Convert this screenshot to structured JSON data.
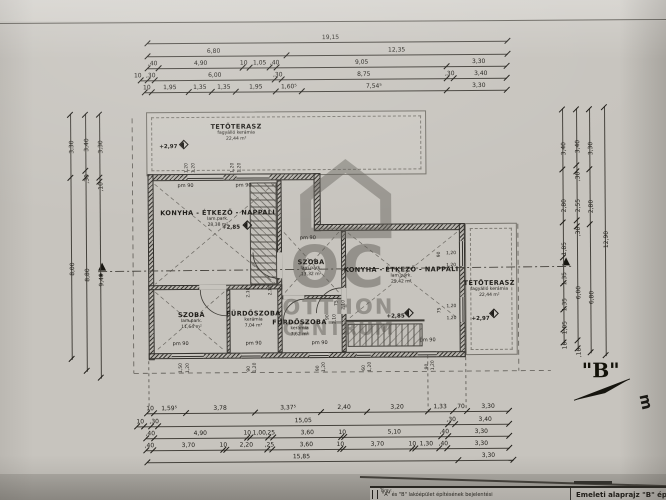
{
  "watermark": {
    "big": "OC",
    "line1": "OTTHON",
    "line2": "CENTRUM"
  },
  "markers": {
    "b": "\"B\"",
    "edge_letter": "m",
    "section_a": "A"
  },
  "pm_text": "pm 90",
  "title_block": {
    "left_label": "Tárgy:",
    "subject": "\"A\" és \"B\" lakóépület építésének bejelentési",
    "drawing": "Emeleti alaprajz \"B\" épü"
  },
  "rooms": [
    {
      "name": "TETŐTERASZ",
      "finish": "fagyálló kerámia",
      "area": "22,44 m²",
      "x": 237,
      "y": 122
    },
    {
      "name": "KONYHA - ÉTKEZŐ - NAPPALI",
      "finish": "lam.park.",
      "area": "28,38 m²",
      "x": 218,
      "y": 208
    },
    {
      "name": "SZOBA",
      "finish": "lam.park.",
      "area": "13,32 m²",
      "x": 311,
      "y": 258
    },
    {
      "name": "KONYHA - ÉTKEZŐ - NAPPALI",
      "finish": "lam.park.",
      "area": "25,42 m²",
      "x": 401,
      "y": 266
    },
    {
      "name": "SZOBA",
      "finish": "lam.park.",
      "area": "11,64 m²",
      "x": 191,
      "y": 310
    },
    {
      "name": "FÜRDŐSZOBA",
      "finish": "kerámia",
      "area": "7,04 m²",
      "x": 253,
      "y": 309
    },
    {
      "name": "FÜRDŐSZOBA",
      "finish": "kerámia",
      "area": "7,62 m²",
      "x": 299,
      "y": 318
    },
    {
      "name": "TETŐTERASZ",
      "finish": "fagyálló kerámia",
      "area": "22,44 m²",
      "x": 489,
      "y": 280
    }
  ],
  "levels": [
    {
      "t": "+2,97",
      "x": 160,
      "y": 143
    },
    {
      "t": "+2,85",
      "x": 222,
      "y": 224
    },
    {
      "t": "+2,85",
      "x": 386,
      "y": 314
    },
    {
      "t": "+2,97",
      "x": 471,
      "y": 317
    }
  ],
  "level_marks": [
    {
      "x": 181,
      "y": 140
    },
    {
      "x": 244,
      "y": 221
    },
    {
      "x": 405,
      "y": 310
    },
    {
      "x": 490,
      "y": 311
    }
  ],
  "pm_positions": [
    {
      "x": 178,
      "y": 182
    },
    {
      "x": 236,
      "y": 182
    },
    {
      "x": 300,
      "y": 235
    },
    {
      "x": 172,
      "y": 340
    },
    {
      "x": 245,
      "y": 340
    },
    {
      "x": 311,
      "y": 340
    },
    {
      "x": 419,
      "y": 338
    }
  ],
  "rot_labels": [
    {
      "t": "1,20",
      "x": 185,
      "y": 172
    },
    {
      "t": "1,20",
      "x": 192,
      "y": 172
    },
    {
      "t": "1,20",
      "x": 231,
      "y": 172
    },
    {
      "t": "1,20",
      "x": 238,
      "y": 172
    },
    {
      "t": "2,10",
      "x": 246,
      "y": 297
    },
    {
      "t": "2,10",
      "x": 268,
      "y": 295
    },
    {
      "t": "75",
      "x": 334,
      "y": 306
    },
    {
      "t": "2,10",
      "x": 341,
      "y": 310
    },
    {
      "t": "90",
      "x": 325,
      "y": 320
    },
    {
      "t": "2,10",
      "x": 332,
      "y": 324
    },
    {
      "t": "1,50",
      "x": 178,
      "y": 372
    },
    {
      "t": "1,20",
      "x": 185,
      "y": 372
    },
    {
      "t": "90",
      "x": 246,
      "y": 371
    },
    {
      "t": "1,20",
      "x": 252,
      "y": 372
    },
    {
      "t": "90",
      "x": 315,
      "y": 371
    },
    {
      "t": "1,20",
      "x": 321,
      "y": 372
    },
    {
      "t": "60",
      "x": 361,
      "y": 371
    },
    {
      "t": "1,20",
      "x": 367,
      "y": 372
    },
    {
      "t": "90",
      "x": 424,
      "y": 370
    },
    {
      "t": "1,20",
      "x": 430,
      "y": 371
    },
    {
      "t": "90",
      "x": 437,
      "y": 258
    },
    {
      "t": "75",
      "x": 437,
      "y": 314
    }
  ],
  "small_labels": [
    {
      "t": "1,20",
      "x": 446,
      "y": 252
    },
    {
      "t": "1,20",
      "x": 446,
      "y": 264
    },
    {
      "t": "1,20",
      "x": 446,
      "y": 305
    },
    {
      "t": "1,20",
      "x": 446,
      "y": 317
    }
  ],
  "dims": {
    "top": [
      {
        "y": 42,
        "x1": 149,
        "x2": 509,
        "ticks": [
          149,
          509
        ],
        "labels": [
          {
            "t": "19,15",
            "x": 332
          }
        ]
      },
      {
        "y": 55,
        "x1": 149,
        "x2": 509,
        "ticks": [
          149,
          288,
          509
        ],
        "labels": [
          {
            "t": "6,80",
            "x": 215
          },
          {
            "t": "12,35",
            "x": 398
          }
        ]
      },
      {
        "y": 67,
        "x1": 149,
        "x2": 508,
        "ticks": [
          149,
          160,
          244,
          251,
          271,
          278,
          448,
          508
        ],
        "labels": [
          {
            "t": ",40",
            "x": 154
          },
          {
            "t": "4,90",
            "x": 202
          },
          {
            "t": "10",
            "x": 245
          },
          {
            "t": "1,05",
            "x": 261
          },
          {
            "t": ",40",
            "x": 276
          },
          {
            "t": "9,05",
            "x": 363
          },
          {
            "t": "3,30",
            "x": 480
          }
        ]
      },
      {
        "y": 79,
        "x1": 142,
        "x2": 508,
        "ticks": [
          142,
          149,
          156,
          276,
          283,
          448,
          455,
          508
        ],
        "labels": [
          {
            "t": "10",
            "x": 139
          },
          {
            "t": ",30",
            "x": 152
          },
          {
            "t": "6,00",
            "x": 216
          },
          {
            "t": ",30",
            "x": 279
          },
          {
            "t": "8,75",
            "x": 365
          },
          {
            "t": ",30",
            "x": 451
          },
          {
            "t": "3,40",
            "x": 482
          }
        ]
      },
      {
        "y": 91,
        "x1": 146,
        "x2": 508,
        "ticks": [
          146,
          153,
          190,
          213,
          237,
          277,
          303,
          448,
          508
        ],
        "labels": [
          {
            "t": "10",
            "x": 148
          },
          {
            "t": "1,95",
            "x": 171
          },
          {
            "t": "1,35",
            "x": 201
          },
          {
            "t": "1,35",
            "x": 225
          },
          {
            "t": "1,95",
            "x": 257
          },
          {
            "t": "1,60⁵",
            "x": 290
          },
          {
            "t": "7,54⁵",
            "x": 375
          },
          {
            "t": "3,30",
            "x": 480
          }
        ]
      }
    ],
    "bottom": [
      {
        "y": 412,
        "x1": 146,
        "x2": 508,
        "ticks": [
          146,
          153,
          185,
          254,
          320,
          366,
          427,
          452,
          466,
          508
        ],
        "labels": [
          {
            "t": "10",
            "x": 149
          },
          {
            "t": "1,59⁵",
            "x": 168
          },
          {
            "t": "3,78",
            "x": 219
          },
          {
            "t": "3,37⁵",
            "x": 287
          },
          {
            "t": "2,40",
            "x": 343
          },
          {
            "t": "3,20",
            "x": 396
          },
          {
            "t": "1,33",
            "x": 439
          },
          {
            "t": ",70",
            "x": 459
          },
          {
            "t": "3,30",
            "x": 487
          }
        ]
      },
      {
        "y": 425,
        "x1": 136,
        "x2": 508,
        "ticks": [
          136,
          143,
          150,
          157,
          447,
          454,
          508
        ],
        "labels": [
          {
            "t": "10",
            "x": 139
          },
          {
            "t": ",30",
            "x": 153
          },
          {
            "t": "15,05",
            "x": 302
          },
          {
            "t": ",30",
            "x": 450
          },
          {
            "t": "3,40",
            "x": 484
          }
        ]
      },
      {
        "y": 437,
        "x1": 145,
        "x2": 508,
        "ticks": [
          145,
          153,
          246,
          249,
          267,
          272,
          340,
          343,
          440,
          447,
          508
        ],
        "labels": [
          {
            "t": ",40",
            "x": 149
          },
          {
            "t": "4,90",
            "x": 199
          },
          {
            "t": "10",
            "x": 246
          },
          {
            "t": "1,00",
            "x": 258
          },
          {
            "t": ",25",
            "x": 269
          },
          {
            "t": "3,60",
            "x": 306
          },
          {
            "t": "10",
            "x": 341
          },
          {
            "t": "5,10",
            "x": 393
          },
          {
            "t": ",40",
            "x": 443
          },
          {
            "t": "3,30",
            "x": 480
          }
        ]
      },
      {
        "y": 449,
        "x1": 145,
        "x2": 508,
        "ticks": [
          145,
          152,
          222,
          225,
          266,
          271,
          339,
          342,
          411,
          414,
          438,
          446,
          508
        ],
        "labels": [
          {
            "t": ",40",
            "x": 148
          },
          {
            "t": "3,70",
            "x": 187
          },
          {
            "t": "10",
            "x": 222
          },
          {
            "t": "2,20",
            "x": 245
          },
          {
            "t": ",25",
            "x": 268
          },
          {
            "t": "3,60",
            "x": 305
          },
          {
            "t": "10",
            "x": 339
          },
          {
            "t": "3,70",
            "x": 376
          },
          {
            "t": "10",
            "x": 411
          },
          {
            "t": "1,30",
            "x": 425
          },
          {
            "t": ",40",
            "x": 442
          },
          {
            "t": "3,30",
            "x": 480
          }
        ]
      },
      {
        "y": 461,
        "x1": 146,
        "x2": 512,
        "ticks": [
          146,
          457,
          512
        ],
        "labels": [
          {
            "t": "15,85",
            "x": 300
          },
          {
            "t": "3,30",
            "x": 487
          }
        ]
      }
    ],
    "left": [
      {
        "x": 71,
        "y1": 112,
        "y2": 358,
        "ticks": [
          113,
          176,
          357
        ],
        "labels": [
          {
            "t": "3,30",
            "y": 143
          },
          {
            "t": "8,00",
            "y": 265
          }
        ]
      },
      {
        "x": 86,
        "y1": 112,
        "y2": 370,
        "ticks": [
          113,
          169,
          176,
          369
        ],
        "labels": [
          {
            "t": "3,40",
            "y": 141
          },
          {
            "t": ",30",
            "y": 173
          },
          {
            "t": "8,80",
            "y": 271
          }
        ]
      },
      {
        "x": 100,
        "y1": 112,
        "y2": 377,
        "ticks": [
          113,
          176,
          180,
          376
        ],
        "labels": [
          {
            "t": "3,30",
            "y": 143
          },
          {
            "t": ",10",
            "y": 181
          },
          {
            "t": "9,40",
            "y": 276
          }
        ]
      }
    ],
    "right": [
      {
        "x": 563,
        "y1": 110,
        "y2": 346,
        "ticks": [
          111,
          171,
          224,
          259,
          285,
          311,
          331,
          344
        ],
        "labels": [
          {
            "t": "3,40",
            "y": 148
          },
          {
            "t": "2,80",
            "y": 205
          },
          {
            "t": "1,85",
            "y": 248
          },
          {
            "t": "1,35",
            "y": 278
          },
          {
            "t": "1,35",
            "y": 304
          },
          {
            "t": "1,05",
            "y": 327
          },
          {
            "t": "10",
            "y": 342
          }
        ]
      },
      {
        "x": 577,
        "y1": 110,
        "y2": 352,
        "ticks": [
          111,
          167,
          173,
          222,
          228,
          342,
          350
        ],
        "labels": [
          {
            "t": "3,40",
            "y": 146
          },
          {
            "t": ",30",
            "y": 174
          },
          {
            "t": "2,55",
            "y": 205
          },
          {
            "t": ",30",
            "y": 229
          },
          {
            "t": "6,00",
            "y": 292
          },
          {
            "t": ",10",
            "y": 350
          }
        ]
      },
      {
        "x": 590,
        "y1": 110,
        "y2": 355,
        "ticks": [
          111,
          171,
          226,
          354
        ],
        "labels": [
          {
            "t": "3,30",
            "y": 148
          },
          {
            "t": "2,80",
            "y": 206
          },
          {
            "t": "6,80",
            "y": 297
          }
        ]
      },
      {
        "x": 605,
        "y1": 108,
        "y2": 358,
        "ticks": [
          109,
          357
        ],
        "labels": [
          {
            "t": "12,90",
            "y": 241
          }
        ]
      }
    ]
  }
}
